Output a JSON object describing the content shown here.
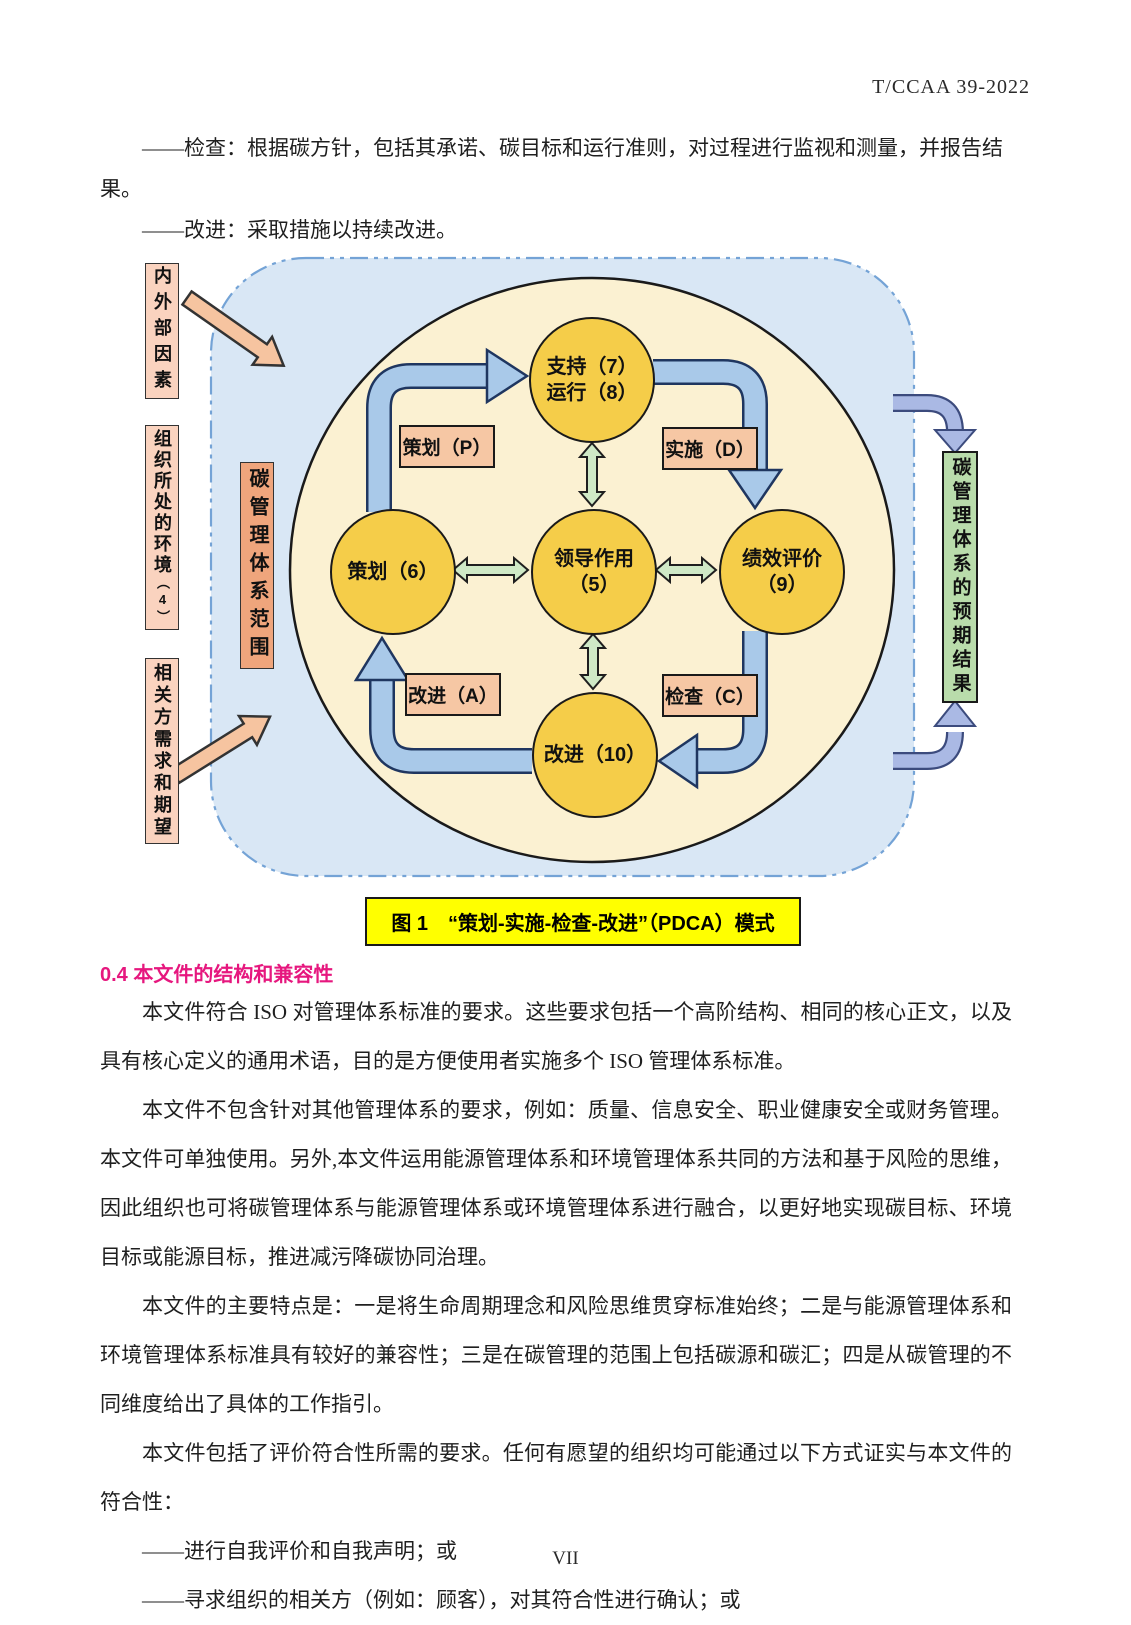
{
  "page": {
    "doc_number": "T/CCAA 39-2022",
    "footer": "VII"
  },
  "intro_lines": [
    "——检查：根据碳方针，包括其承诺、碳目标和运行准则，对过程进行监视和测量，并报告结果。",
    "——改进：采取措施以持续改进。"
  ],
  "figure": {
    "caption": "图 1　“策划-实施-检查-改进”（PDCA）模式",
    "context_boxes": [
      {
        "label": "内外部因素"
      },
      {
        "label": "组织所处的环境",
        "sub": "（4）"
      },
      {
        "label": "相关方需求和期望"
      }
    ],
    "scope_box": "碳管理体系范围",
    "result_box": "碳管理体系的预期结果",
    "circles": [
      {
        "id": "support-operation",
        "label": "支持（7）\n运行（8）"
      },
      {
        "id": "planning",
        "label": "策划（6）"
      },
      {
        "id": "leadership",
        "label": "领导作用\n（5）"
      },
      {
        "id": "performance-evaluation",
        "label": "绩效评价\n（9）"
      },
      {
        "id": "improvement",
        "label": "改进（10）"
      }
    ],
    "pdca_labels": [
      {
        "label": "策划（P）"
      },
      {
        "label": "实施（D）"
      },
      {
        "label": "改进（A）"
      },
      {
        "label": "检查（C）"
      }
    ]
  },
  "section": {
    "heading": "0.4 本文件的结构和兼容性",
    "paragraphs": [
      "本文件符合 ISO 对管理体系标准的要求。这些要求包括一个高阶结构、相同的核心正文，以及具有核心定义的通用术语，目的是方便使用者实施多个 ISO 管理体系标准。",
      "本文件不包含针对其他管理体系的要求，例如：质量、信息安全、职业健康安全或财务管理。本文件可单独使用。另外,本文件运用能源管理体系和环境管理体系共同的方法和基于风险的思维，因此组织也可将碳管理体系与能源管理体系或环境管理体系进行融合，以更好地实现碳目标、环境目标或能源目标，推进减污降碳协同治理。",
      "本文件的主要特点是：一是将生命周期理念和风险思维贯穿标准始终；二是与能源管理体系和环境管理体系标准具有较好的兼容性；三是在碳管理的范围上包括碳源和碳汇；四是从碳管理的不同维度给出了具体的工作指引。",
      "本文件包括了评价符合性所需的要求。任何有愿望的组织均可能通过以下方式证实与本文件的符合性："
    ],
    "list_items": [
      "——进行自我评价和自我声明；或",
      "——寻求组织的相关方（例如：顾客），对其符合性进行确认；或"
    ]
  },
  "colors": {
    "outer_fill": "#d9e7f5",
    "outer_border": "#74a3d6",
    "ellipse_fill": "#fbf1d2",
    "circle_fill": "#f5cd49",
    "cycle_arrow_fill": "#a9c9e9",
    "cycle_arrow_border": "#1f3660",
    "link_arrow_fill": "#cfe9c6",
    "pdca_label_fill": "#f6c7a4",
    "context_box_fill": "#fad3bf",
    "scope_box_fill": "#efa57c",
    "result_box_fill": "#b9dcab",
    "side_arrow_fill": "#f6c4a0",
    "result_arrow_fill": "#aab9e4",
    "caption_bg": "#ffff00",
    "heading_color": "#e6177e"
  }
}
